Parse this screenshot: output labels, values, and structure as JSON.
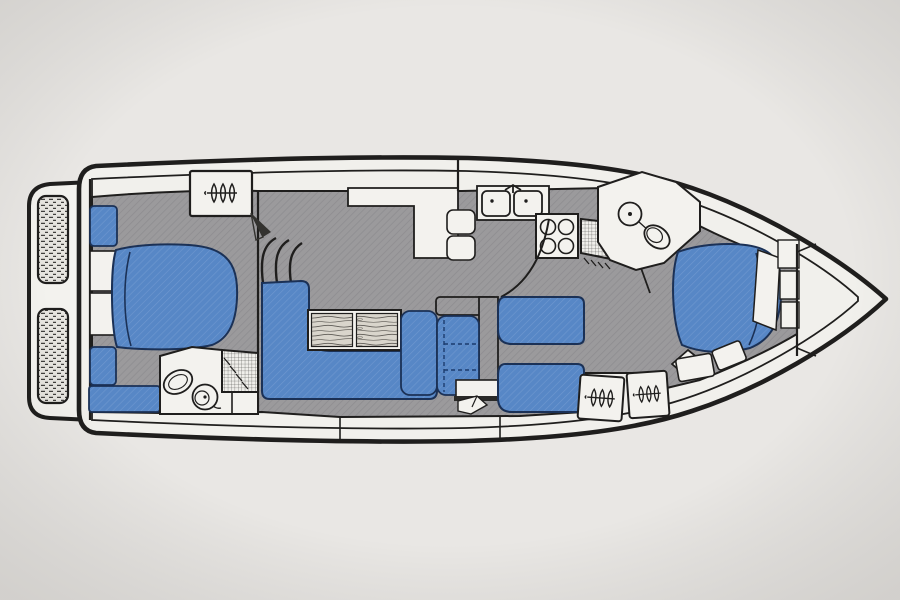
{
  "meta": {
    "title": "Motor yacht interior accommodation plan, side-on deck view with bow to the right",
    "diagram_type": "boat-floor-plan",
    "orientation": "bow-right-stern-left"
  },
  "colors": {
    "background": "#e9e7e4",
    "background_edge": "#dcdad6",
    "hull_fill": "#f1f0ec",
    "white_fixture": "#f3f2ee",
    "outline": "#1f1e1d",
    "floor_gray": "#9b9a9c",
    "floor_hatch": "#8e8d90",
    "upholstery_blue": "#5787c6",
    "blue_edge": "#1b3156",
    "wood": "#d9d5cc",
    "tread": "#e6e4df"
  },
  "rooms": [
    {
      "name": "swim-platform",
      "features": [
        "two hatched tread panels"
      ]
    },
    {
      "name": "aft-cabin",
      "features": [
        "double berth",
        "side shelves",
        "seat strips",
        "wardrobe with hangers",
        "curved steps"
      ]
    },
    {
      "name": "aft-head",
      "features": [
        "washbasin",
        "toilet",
        "cross-hatched shower"
      ]
    },
    {
      "name": "salon",
      "features": [
        "L-shaped settee",
        "two-leaf wood table",
        "armchair",
        "folding chair with dashed outline",
        "sideboard counter",
        "steps"
      ]
    },
    {
      "name": "galley",
      "features": [
        "double sink with faucet",
        "four-burner stove",
        "cross-hatched drainer"
      ]
    },
    {
      "name": "mid-cabin",
      "features": [
        "twin berths",
        "two hanging lockers with hangers",
        "diamond seat"
      ]
    },
    {
      "name": "forward-head",
      "features": [
        "round washbasin",
        "toilet"
      ]
    },
    {
      "name": "forward-cabin",
      "features": [
        "island double berth",
        "pillow",
        "hull shelves",
        "benches"
      ]
    },
    {
      "name": "bow",
      "features": [
        "anchor locker bulkhead"
      ]
    }
  ],
  "icon_glyphs": {
    "hanger-icon": "three clothes hangers on a rail",
    "burner-icon": "circle",
    "sink-icon": "rounded basin with faucet dot"
  }
}
